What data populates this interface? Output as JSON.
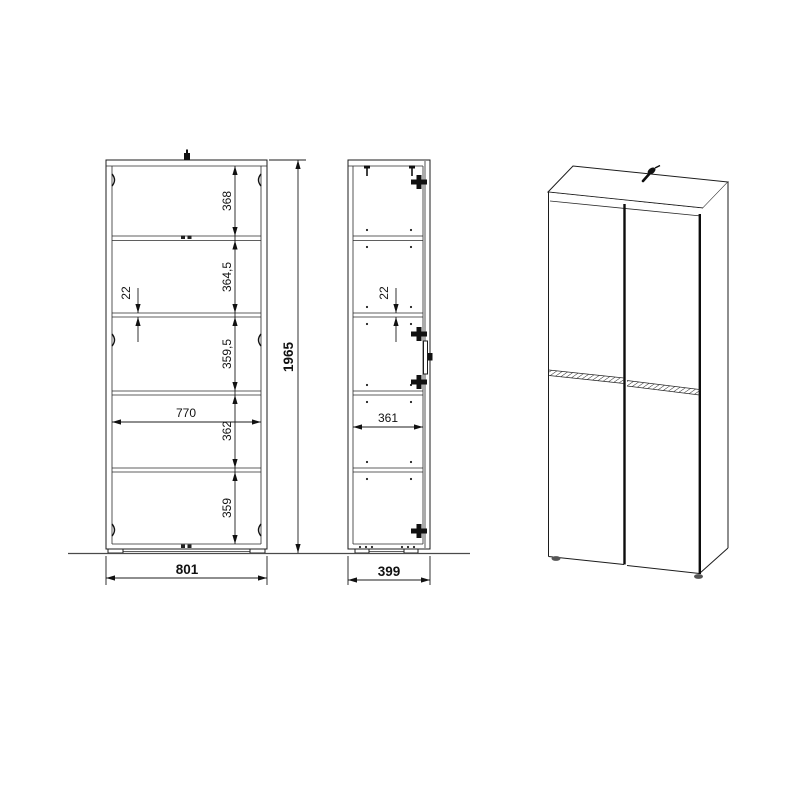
{
  "front_view": {
    "dims": {
      "section1": "368",
      "section2": "364,5",
      "section3": "359,5",
      "section4": "362",
      "section5": "359",
      "shelf_thickness": "22",
      "inner_width": "770",
      "overall_width": "801",
      "overall_height": "1965"
    }
  },
  "side_view": {
    "dims": {
      "shelf_thickness": "22",
      "inner_depth": "361",
      "overall_depth": "399"
    }
  }
}
